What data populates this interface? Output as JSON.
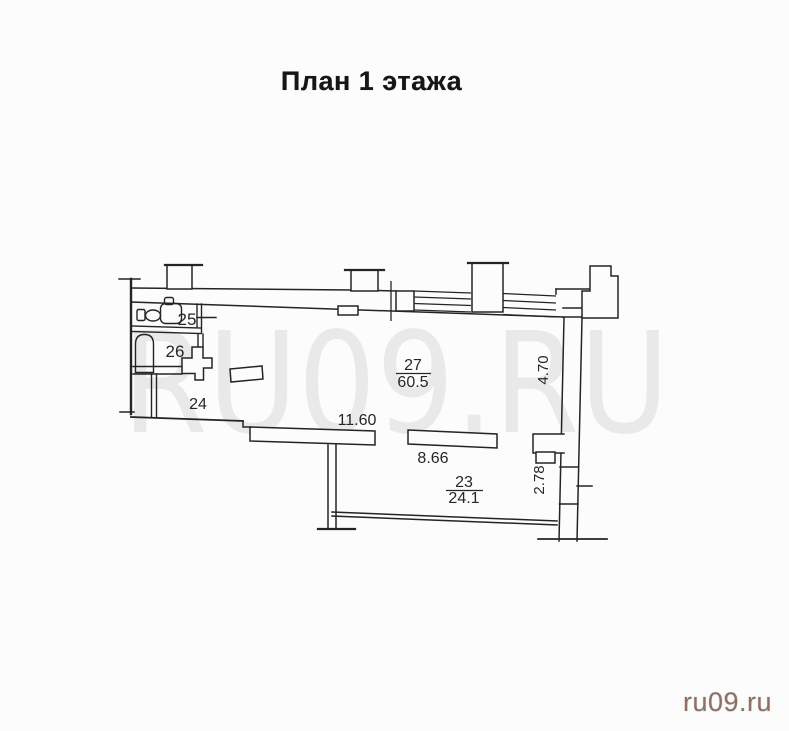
{
  "title": "План 1 этажа",
  "watermark": "RU09.RU",
  "site_logo": "ru09.ru",
  "rooms": {
    "r23": {
      "number": "23",
      "area": "24.1"
    },
    "r24": {
      "number": "24"
    },
    "r25": {
      "number": "25"
    },
    "r26": {
      "number": "26"
    },
    "r27": {
      "number": "27",
      "area": "60.5"
    }
  },
  "dimensions": {
    "corridor_length": "11.60",
    "partition_length": "8.66",
    "right_wall_top": "4.70",
    "right_wall_bottom": "2.78"
  },
  "colors": {
    "paper": "#fcfcfc",
    "ink": "#242424",
    "watermark": "#e9e9e9",
    "logo": "#8d7165"
  }
}
